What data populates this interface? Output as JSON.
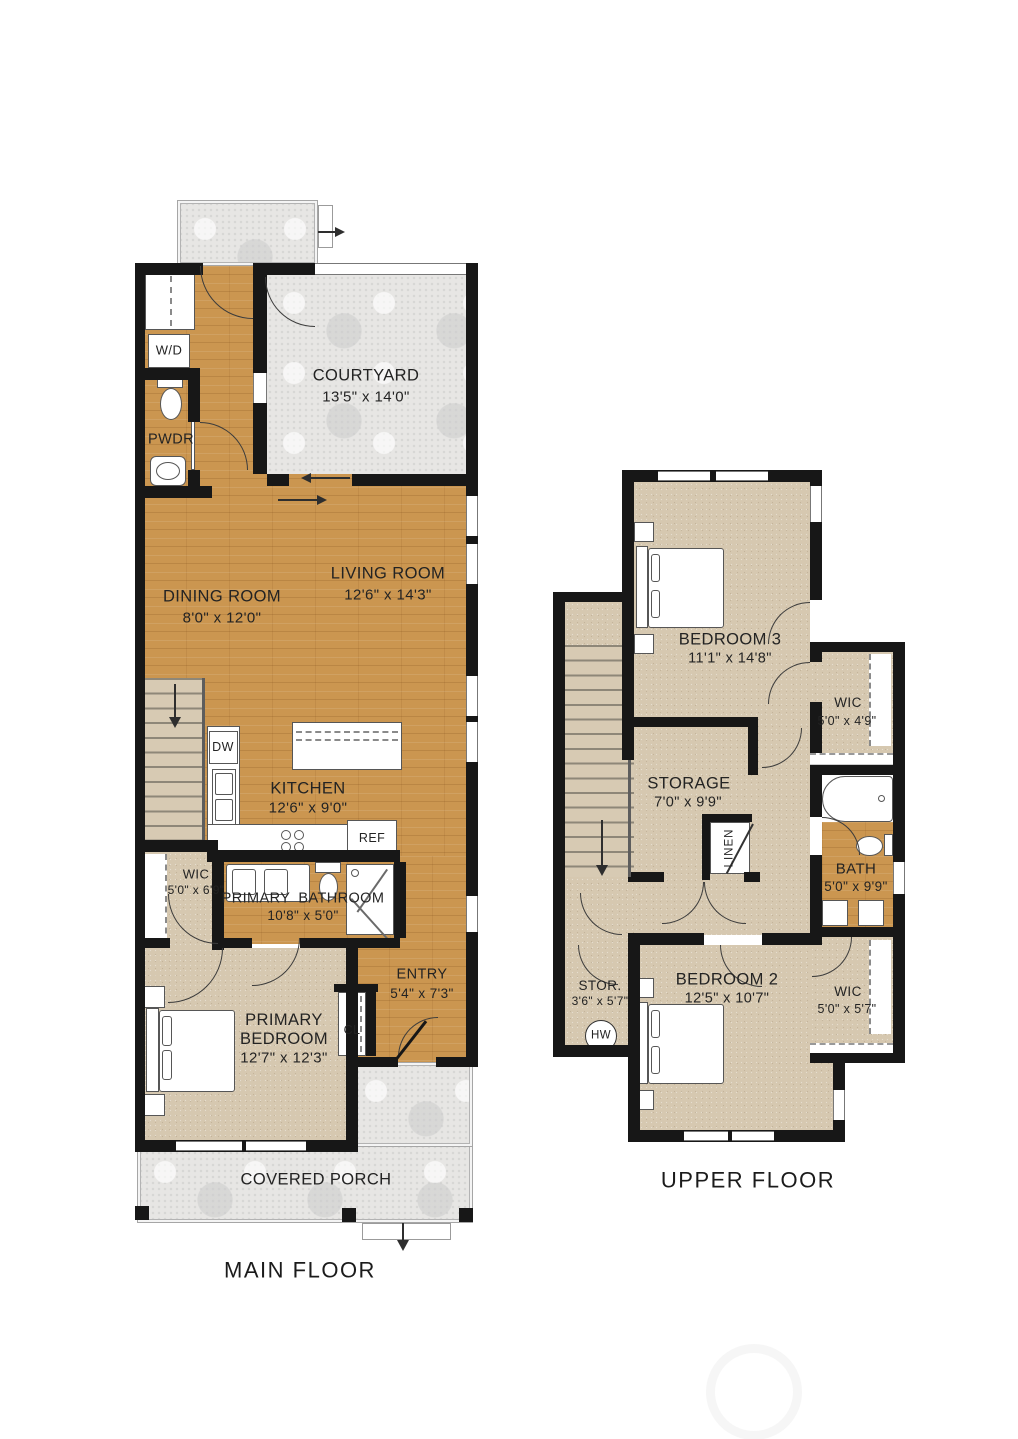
{
  "colors": {
    "wood_floor": "#cb9650",
    "carpet": "#d6c8b0",
    "concrete": "#e7e6e4",
    "wall": "#171717"
  },
  "main_floor": {
    "title": "MAIN FLOOR",
    "rooms": {
      "courtyard": {
        "name": "COURTYARD",
        "dims": "13'5\" x 14'0\""
      },
      "dining_room": {
        "name": "DINING ROOM",
        "dims": "8'0\" x 12'0\""
      },
      "living_room": {
        "name": "LIVING ROOM",
        "dims": "12'6\" x 14'3\""
      },
      "kitchen": {
        "name": "KITCHEN",
        "dims": "12'6\" x 9'0\""
      },
      "wic": {
        "name": "WIC",
        "dims": "5'0\" x 6'9\""
      },
      "primary_bathroom": {
        "name": "PRIMARY BATHROOM",
        "dims": "10'8\" x 5'0\""
      },
      "primary_bedroom": {
        "name": "PRIMARY BEDROOM",
        "dims": "12'7\" x 12'3\""
      },
      "entry": {
        "name": "ENTRY",
        "dims": "5'4\" x 7'3\""
      },
      "covered_porch": {
        "name": "COVERED PORCH"
      },
      "powder_room": {
        "name": "PWDR"
      }
    },
    "fixtures": {
      "washer_dryer": "W/D",
      "dishwasher": "DW",
      "refrigerator": "REF",
      "closet": "CL"
    }
  },
  "upper_floor": {
    "title": "UPPER FLOOR",
    "rooms": {
      "bedroom_3": {
        "name": "BEDROOM 3",
        "dims": "11'1\" x 14'8\""
      },
      "wic_bedroom_3": {
        "name": "WIC",
        "dims": "5'0\" x 4'9\""
      },
      "storage": {
        "name": "STORAGE",
        "dims": "7'0\" x 9'9\""
      },
      "linen": {
        "name": "LINEN"
      },
      "bath": {
        "name": "BATH",
        "dims": "5'0\" x 9'9\""
      },
      "bedroom_2": {
        "name": "BEDROOM 2",
        "dims": "12'5\" x 10'7\""
      },
      "wic_bedroom_2": {
        "name": "WIC",
        "dims": "5'0\" x 5'7\""
      },
      "storage_closet": {
        "name": "STOR.",
        "dims": "3'6\" x 5'7\""
      },
      "water_heater": {
        "name": "HW"
      }
    }
  }
}
